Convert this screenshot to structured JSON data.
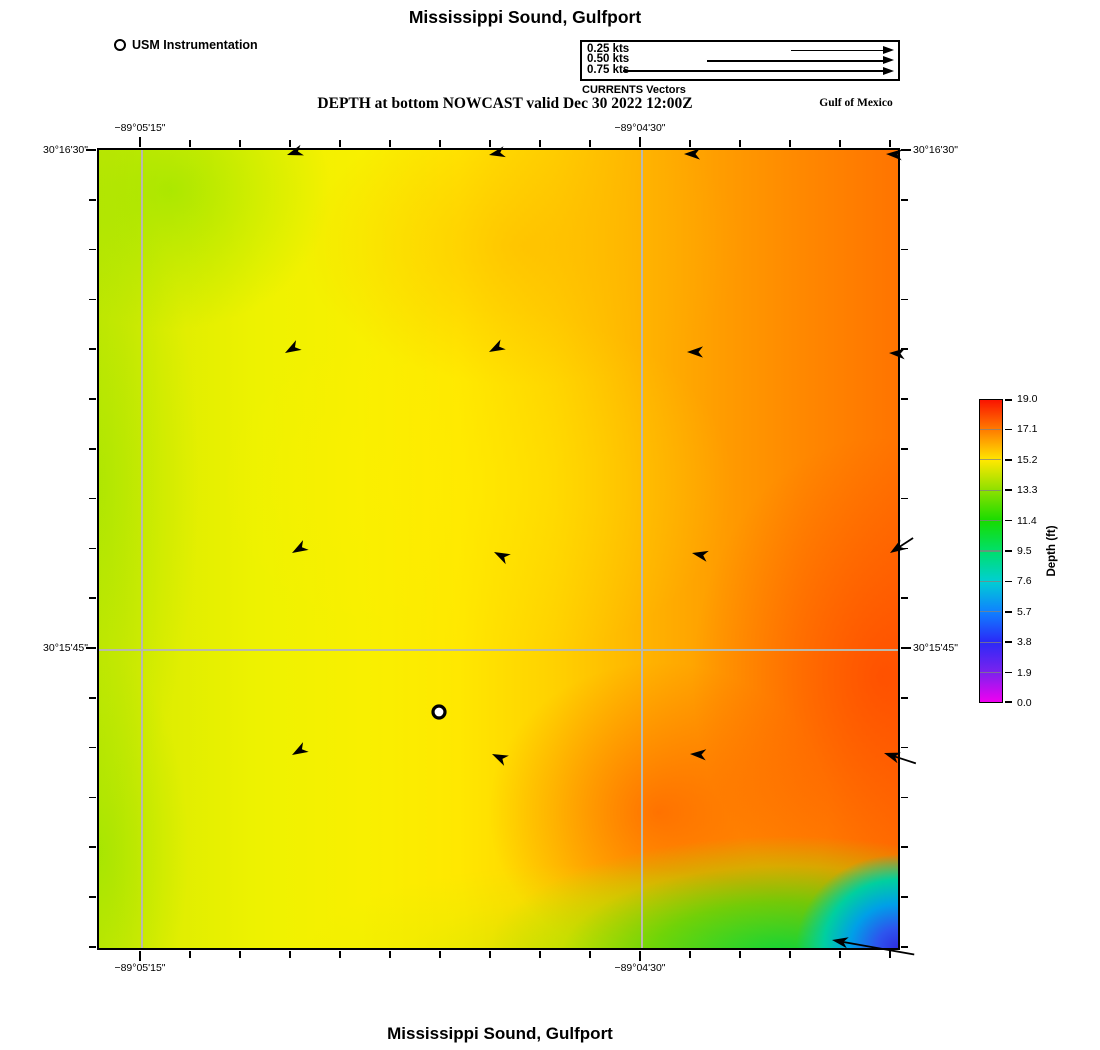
{
  "figure": {
    "title_top": "Mississippi Sound, Gulfport",
    "title_bottom": "Mississippi Sound, Gulfport",
    "subtitle": "DEPTH at bottom NOWCAST valid Dec 30 2022 12:00Z",
    "region_label": "Gulf of Mexico",
    "instrumentation_legend": "USM Instrumentation",
    "vector_legend_caption": "CURRENTS Vectors"
  },
  "chart_data": {
    "type": "heatmap",
    "title": "Mississippi Sound, Gulfport",
    "variable": "DEPTH at bottom",
    "product": "NOWCAST",
    "valid_time": "Dec 30 2022 12:00Z",
    "x_axis": {
      "ticks": [
        {
          "label": "−89°05'15\"",
          "frac": 0.054
        },
        {
          "label": "−89°04'30\"",
          "frac": 0.676
        }
      ]
    },
    "y_axis": {
      "ticks": [
        {
          "label": "30°16'30\"",
          "frac": 0.003
        },
        {
          "label": "30°15'45\"",
          "frac": 0.623
        }
      ]
    },
    "colorbar": {
      "title": "Depth (ft)",
      "min": 0.0,
      "max": 19.0,
      "tick_labels": [
        "19.0",
        "17.1",
        "15.2",
        "13.3",
        "11.4",
        "9.5",
        "7.6",
        "5.7",
        "3.8",
        "1.9",
        "0.0"
      ],
      "gradient_top_to_bottom": [
        "#fa1400",
        "#ff7d00",
        "#ffe800",
        "#8ce000",
        "#17dc00",
        "#00e06a",
        "#00cfd2",
        "#0f82ff",
        "#2a2af8",
        "#7a22ee",
        "#f000f0"
      ]
    },
    "field_colors": {
      "shallow_left": "#d9ec00",
      "mid_yellow": "#ffe800",
      "deep_right_orange": "#ff7400",
      "deepest_red": "#ff3c00",
      "corner_blue": "#2e2ee0",
      "bottom_green": "#00d63c"
    },
    "vector_scale": {
      "units": "kts",
      "items": [
        {
          "label": "0.25 kts",
          "length_px": 92
        },
        {
          "label": "0.50 kts",
          "length_px": 176
        },
        {
          "label": "0.75 kts",
          "length_px": 260
        }
      ]
    },
    "instrument": {
      "x": 340,
      "y": 562
    },
    "current_vectors": [
      {
        "x": 188,
        "y": 5,
        "angle": 162,
        "tail": 0
      },
      {
        "x": 390,
        "y": 5,
        "angle": 168,
        "tail": 0
      },
      {
        "x": 585,
        "y": 4,
        "angle": 180,
        "tail": 0
      },
      {
        "x": 787,
        "y": 4,
        "angle": 183,
        "tail": 0
      },
      {
        "x": 186,
        "y": 203,
        "angle": 150,
        "tail": 0
      },
      {
        "x": 390,
        "y": 202,
        "angle": 152,
        "tail": 0
      },
      {
        "x": 588,
        "y": 202,
        "angle": 180,
        "tail": 0
      },
      {
        "x": 790,
        "y": 203,
        "angle": 183,
        "tail": 0
      },
      {
        "x": 193,
        "y": 403,
        "angle": 150,
        "tail": 0
      },
      {
        "x": 395,
        "y": 402,
        "angle": 207,
        "tail": 0
      },
      {
        "x": 593,
        "y": 403,
        "angle": 192,
        "tail": 0
      },
      {
        "x": 791,
        "y": 403,
        "angle": 147,
        "tail": 16
      },
      {
        "x": 193,
        "y": 605,
        "angle": 150,
        "tail": 0
      },
      {
        "x": 393,
        "y": 604,
        "angle": 205,
        "tail": 0
      },
      {
        "x": 591,
        "y": 604,
        "angle": 183,
        "tail": 0
      },
      {
        "x": 785,
        "y": 603,
        "angle": 198,
        "tail": 22
      },
      {
        "x": 733,
        "y": 790,
        "angle": 190,
        "tail": 72
      }
    ]
  }
}
